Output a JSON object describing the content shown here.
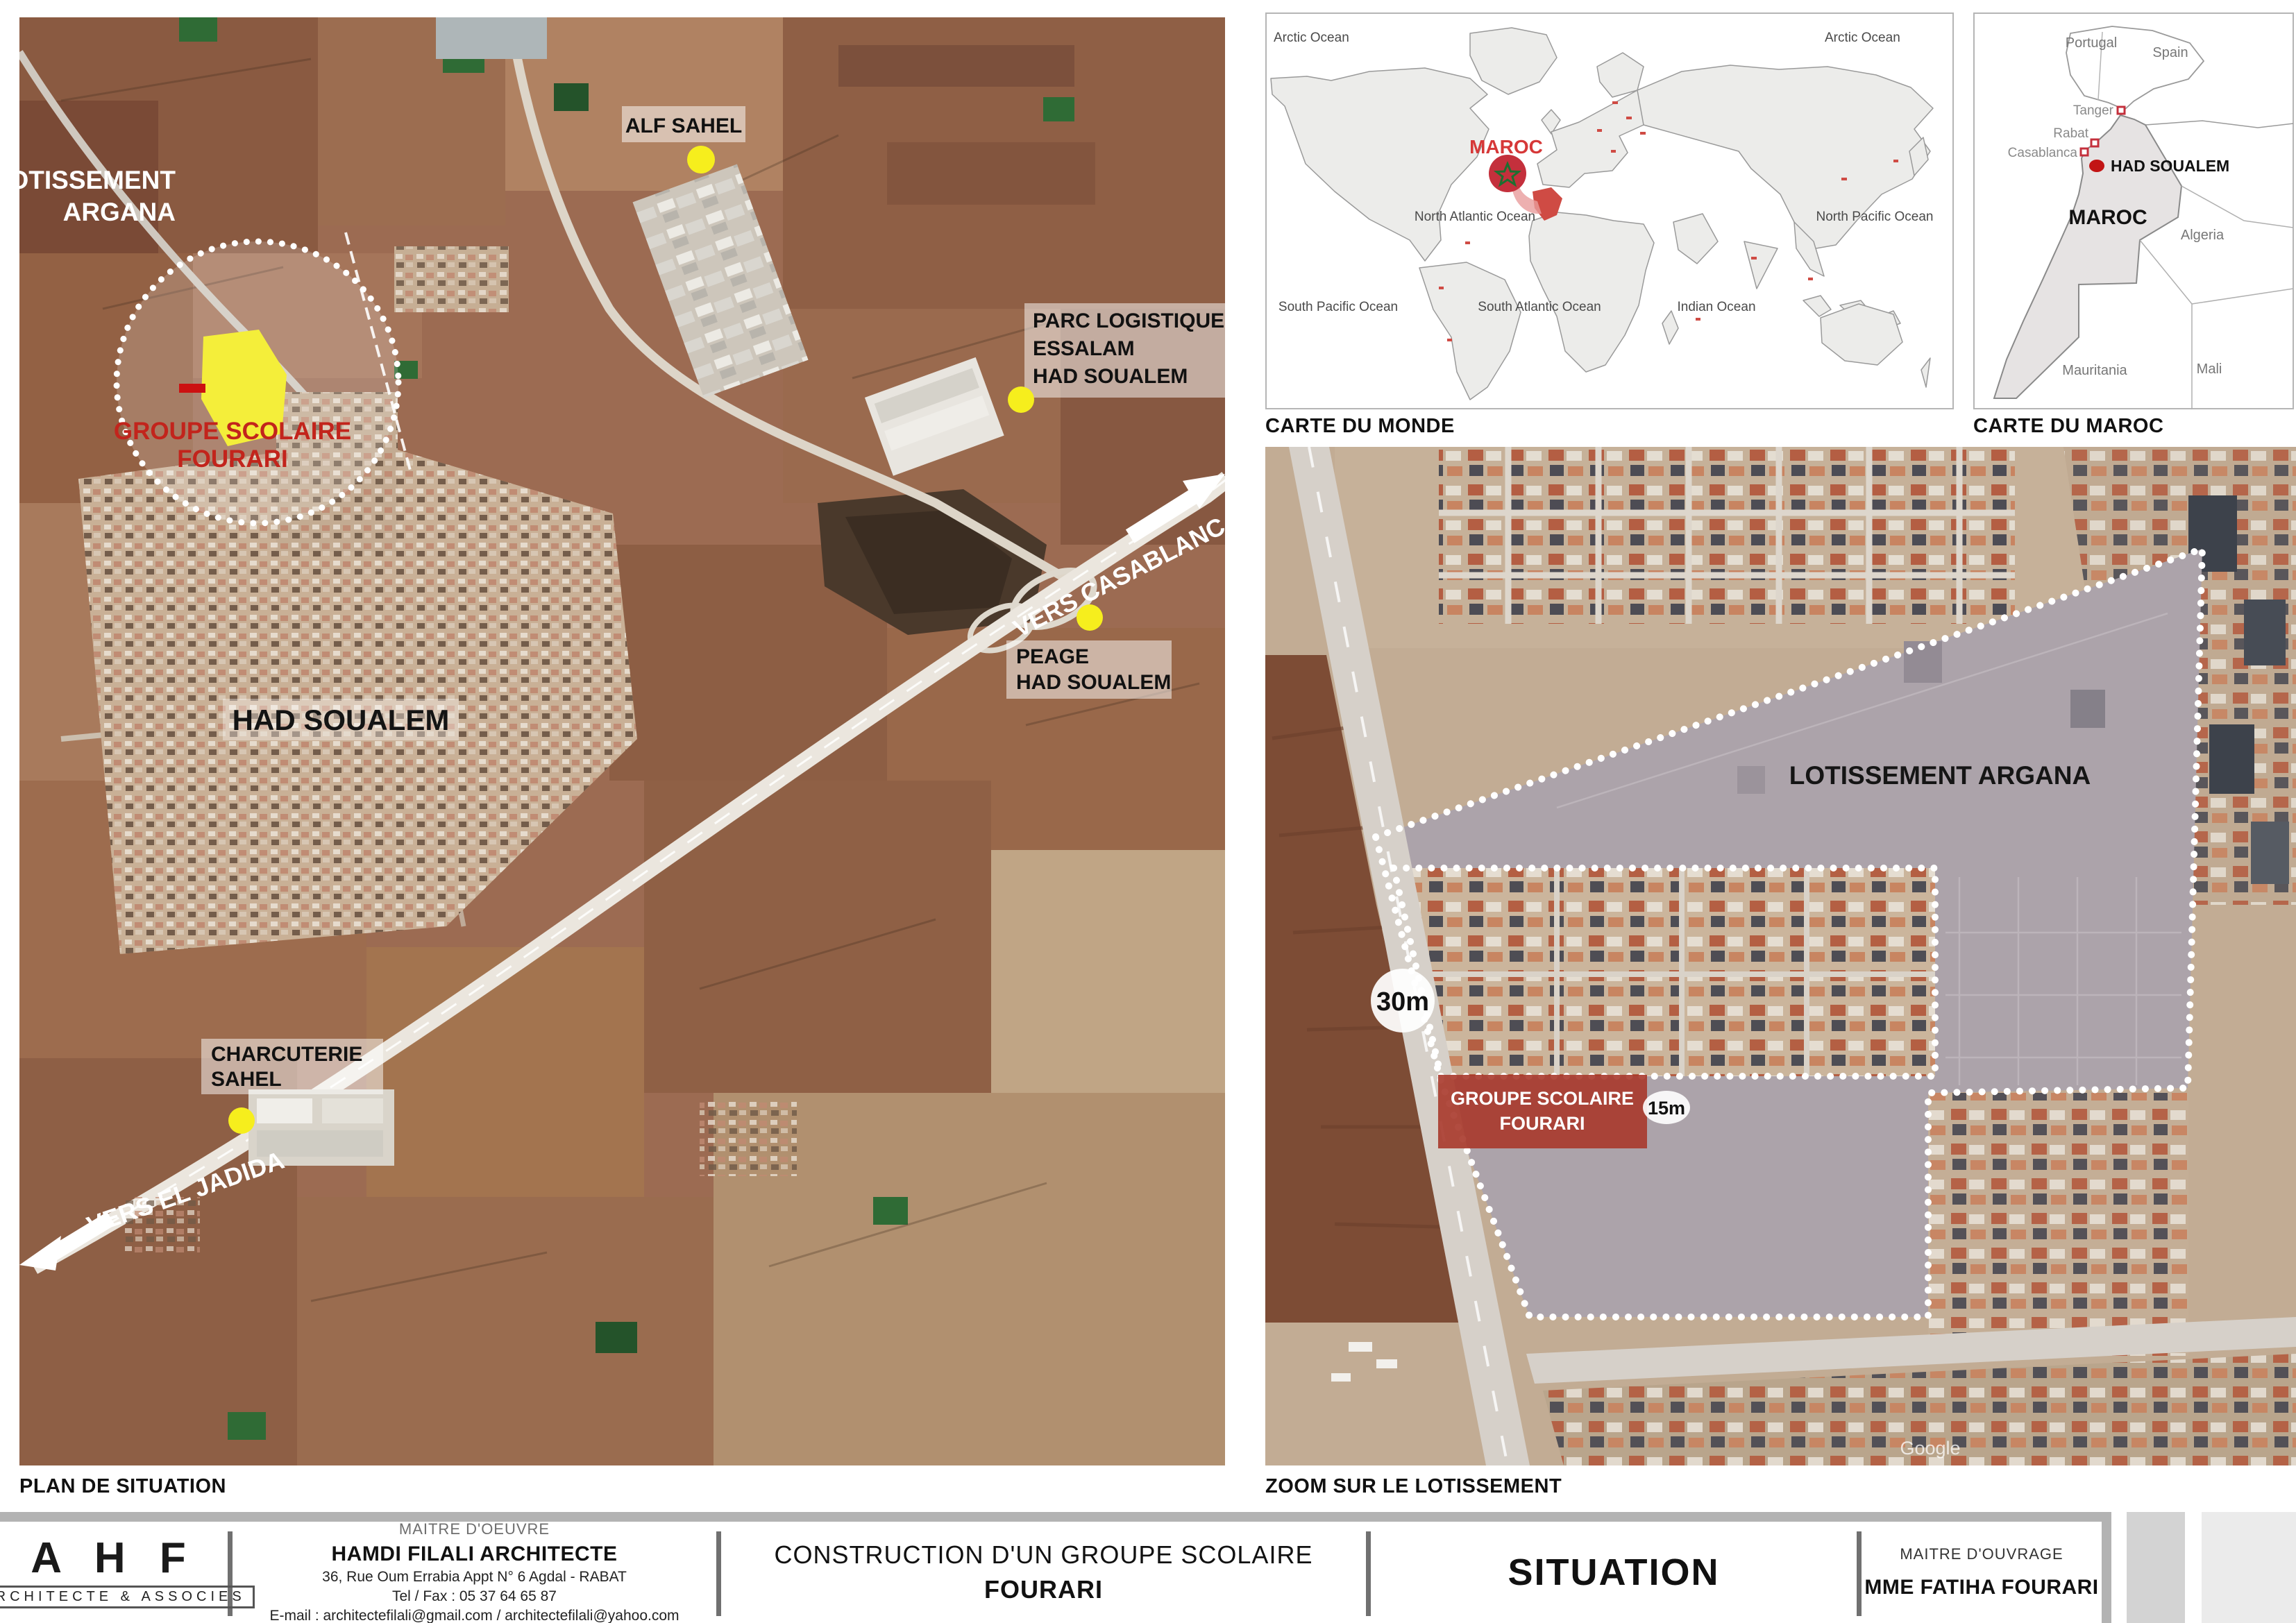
{
  "captions": {
    "plan": "PLAN DE SITUATION",
    "monde": "CARTE DU MONDE",
    "maroc": "CARTE DU MAROC",
    "zoom": "ZOOM SUR LE LOTISSEMENT"
  },
  "plan_map": {
    "lotissement_line1": "LOTISSEMENT",
    "lotissement_line2": "ARGANA",
    "groupe_line1": "GROUPE SCOLAIRE",
    "groupe_line2": "FOURARI",
    "alf_sahel": "ALF SAHEL",
    "parc_line1": "PARC LOGISTIQUE",
    "parc_line2": "ESSALAM",
    "parc_line3": "HAD SOUALEM",
    "vers_casablanca": "VERS CASABLANCA",
    "peage_line1": "PEAGE",
    "peage_line2": "HAD SOUALEM",
    "city": "HAD SOUALEM",
    "charcuterie_line1": "CHARCUTERIE",
    "charcuterie_line2": "SAHEL",
    "vers_el_jadida": "VERS EL JADIDA"
  },
  "world_map": {
    "maroc": "MAROC",
    "arctic_left": "Arctic Ocean",
    "arctic_right": "Arctic Ocean",
    "north_atlantic": "North Atlantic Ocean",
    "north_pacific": "North Pacific Ocean",
    "south_pacific": "South Pacific Ocean",
    "south_atlantic": "South Atlantic Ocean",
    "indian": "Indian Ocean"
  },
  "maroc_map": {
    "portugal": "Portugal",
    "spain": "Spain",
    "tanger": "Tanger",
    "rabat": "Rabat",
    "casablanca": "Casablanca",
    "had_soualem": "HAD SOUALEM",
    "maroc": "MAROC",
    "algeria": "Algeria",
    "mauritania": "Mauritania",
    "mali": "Mali"
  },
  "zoom_map": {
    "lotissement": "LOTISSEMENT ARGANA",
    "road_width": "30m",
    "plot_width": "15m",
    "groupe_line1": "GROUPE SCOLAIRE",
    "groupe_line2": "FOURARI",
    "watermark": "Google"
  },
  "titleblock": {
    "logo": "A H F",
    "logo_sub": "ARCHITECTE & ASSOCIES",
    "moe_label": "MAITRE D'OEUVRE",
    "moe_name": "HAMDI FILALI ARCHITECTE",
    "moe_address": "36, Rue Oum Errabia Appt N° 6 Agdal - RABAT",
    "moe_tel": "Tel / Fax : 05 37 64 65 87",
    "moe_email": "E-mail : architectefilali@gmail.com / architectefilali@yahoo.com",
    "project_line1": "CONSTRUCTION D'UN GROUPE SCOLAIRE",
    "project_line2": "FOURARI",
    "sheet": "SITUATION",
    "moa_label": "MAITRE D'OUVRAGE",
    "moa_name": "MME FATIHA FOURARI"
  },
  "colors": {
    "poi_yellow": "#f6ee1d",
    "school_red": "#a8392b",
    "label_red": "#c2332b",
    "maroc_red": "#c4303c",
    "land_gray": "#ececea",
    "bar_gray": "#b3b3b3"
  }
}
